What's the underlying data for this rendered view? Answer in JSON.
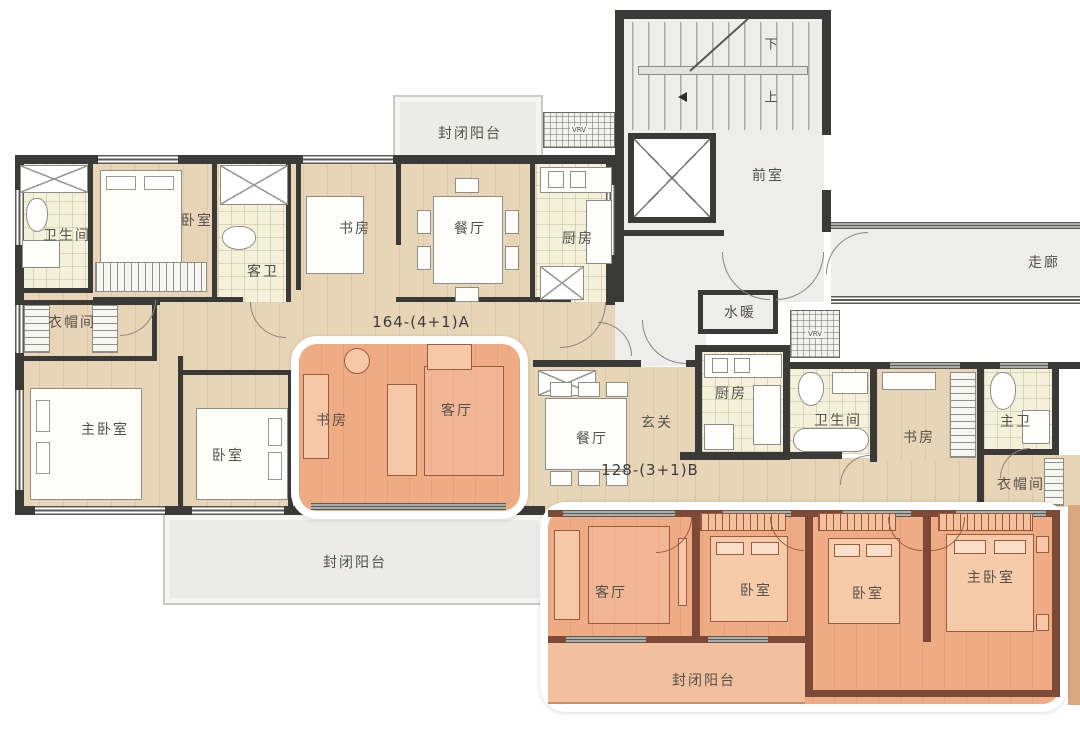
{
  "floorplan": {
    "unit_a": {
      "code": "164-(4+1)A",
      "rooms": {
        "balcony_top": "封闭阳台",
        "bath": "卫生间",
        "bedroom": "卧室",
        "guest_bath": "客卫",
        "study": "书房",
        "dining": "餐厅",
        "kitchen": "厨房",
        "cloakroom": "衣帽间",
        "master_bedroom": "主卧室",
        "bedroom2": "卧室",
        "study2": "书房",
        "living": "客厅",
        "balcony_bottom": "封闭阳台"
      }
    },
    "core": {
      "stair_down": "下",
      "stair_up": "上",
      "front_room": "前室",
      "plumbing": "水暖",
      "corridor": "走廊",
      "vrv_top": "VRV",
      "vrv_side": "VRV"
    },
    "unit_b": {
      "code": "128-(3+1)B",
      "rooms": {
        "dining": "餐厅",
        "entry": "玄关",
        "kitchen": "厨房",
        "bath": "卫生间",
        "study": "书房",
        "master_bath": "主卫",
        "cloakroom": "衣帽间",
        "living": "客厅",
        "bedroom1": "卧室",
        "bedroom2": "卧室",
        "master_bedroom": "主卧室",
        "balcony": "封闭阳台"
      }
    },
    "colors": {
      "wall": "#3a3a38",
      "wall_highlight": "#7c4a37",
      "floor_wood": "#e8d5b7",
      "floor_tile": "#f4f0da",
      "floor_gray": "#ededeb",
      "highlight_fill": "#efab84",
      "highlight_balcony": "#f3c09f"
    }
  }
}
